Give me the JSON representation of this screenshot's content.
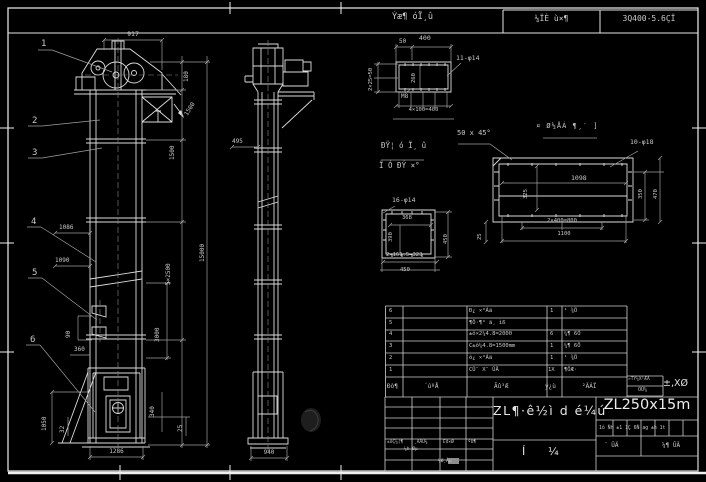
{
  "colors": {
    "background": "#000000",
    "line": "#dcdcdc",
    "dim_line": "#9f9f9f",
    "text": "#c9c9c9",
    "bright_text": "#ededed"
  },
  "top_bar": {
    "ratio_note_top": "Ýæ¶ óÏ¸û",
    "ratio_note_bottom": "400",
    "field_mid": "¼ÏÈ ù×¶",
    "field_right": "3Q400-5.6ÇÏ"
  },
  "front_view": {
    "balloons": [
      "1",
      "2",
      "3",
      "4",
      "5",
      "6"
    ],
    "dims": {
      "w917": "917",
      "h180": "180",
      "h1500_diag": "1500",
      "h1500": "1500",
      "h5x2500": "5×2500",
      "h3000": "3000",
      "h15000": "15000",
      "w1086": "1086",
      "w1090": "1090",
      "h90": "90",
      "w360": "360",
      "h1050": "1050",
      "h32": "32",
      "h340": "340",
      "h25": "25",
      "w1286": "1286"
    }
  },
  "side_view": {
    "dims": {
      "w495": "495",
      "w940": "940"
    }
  },
  "detail_flange_top": {
    "dims": {
      "w50": "50",
      "left": "2×25=50",
      "inner": "260",
      "bottom": "4×100=400"
    },
    "labels": {
      "holes": "11-φ14",
      "thread": "M8"
    }
  },
  "notes": {
    "chamfer": "50 x 45°",
    "line1": "ÐŸ¦ ó Ï¸ û",
    "line2": "Ï Ó ÐÝ ×°"
  },
  "detail_flange_square": {
    "labels": {
      "holes": "16-φ14"
    },
    "dims": {
      "inner_w": "368",
      "inner_h": "390",
      "right": "450",
      "bottom1": "2×161.5=323",
      "bottom2": "450"
    }
  },
  "detail_flange_long": {
    "title": "¤ Ø½ÅÁ ¶¸′ ]",
    "labels": {
      "holes": "10-φ18"
    },
    "dims": {
      "inner": "1098",
      "left": "325",
      "right1": "350",
      "right2": "470",
      "side": "25",
      "bottom1": "2×400=800",
      "bottom2": "1100"
    }
  },
  "bom": {
    "header": {
      "no": "Ðò¶",
      "code": "´úºÅ",
      "name": "Ãû³Æ",
      "qty": "ý¿ù",
      "material": "²ÄÁÏ"
    },
    "rows": [
      {
        "no": "6",
        "code": "",
        "name": "Ð¿ ×°Áä",
        "qty": "1",
        "material": "¹ ¾Ö"
      },
      {
        "no": "5",
        "code": "",
        "name": "¶Ô·¶° ä¸ ìß",
        "qty": "",
        "material": ""
      },
      {
        "no": "4",
        "code": "",
        "name": "±ô×2¼4.8=2000",
        "qty": "6",
        "material": "¼¶ 6Ö"
      },
      {
        "no": "3",
        "code": "",
        "name": "C±ô¼4.8=1500mm",
        "qty": "1",
        "material": "¼¶ 6Ö"
      },
      {
        "no": "2",
        "code": "",
        "name": "ô¿ ×°Áä",
        "qty": "1",
        "material": "¹ ¾Ö"
      },
      {
        "no": "1",
        "code": "",
        "name": "CÛ¨ X¨ ÛÄ",
        "qty": "1X",
        "material": "¶ÖÆ·"
      }
    ]
  },
  "title_block": {
    "drawing_title": "ZL¶·ê½ì d é¼ú",
    "subtitle_char1": "Í",
    "subtitle_char2": "¼",
    "model": "ZL250x15m",
    "info_row": "1ô Ñh  ±1 1Ç  6Ñ ag  ±h 1t",
    "cell_left": "¨ ÛÄ",
    "cell_right": "¼¶ ÛÄ",
    "std_box_top": "»TÝ¼X¹ÆÅ",
    "std_box_bottom": "ÕÛ¼",
    "approval_mark": "±,XØ",
    "sig_labels": [
      "±ôÇ¼(¶",
      "¸ÄÅÛ¼",
      "Êð×Ø",
      "ºÛ¶"
    ],
    "sig_row2": "¼h Øµ",
    "sig_row3": "¼Ø¸Åµ"
  }
}
